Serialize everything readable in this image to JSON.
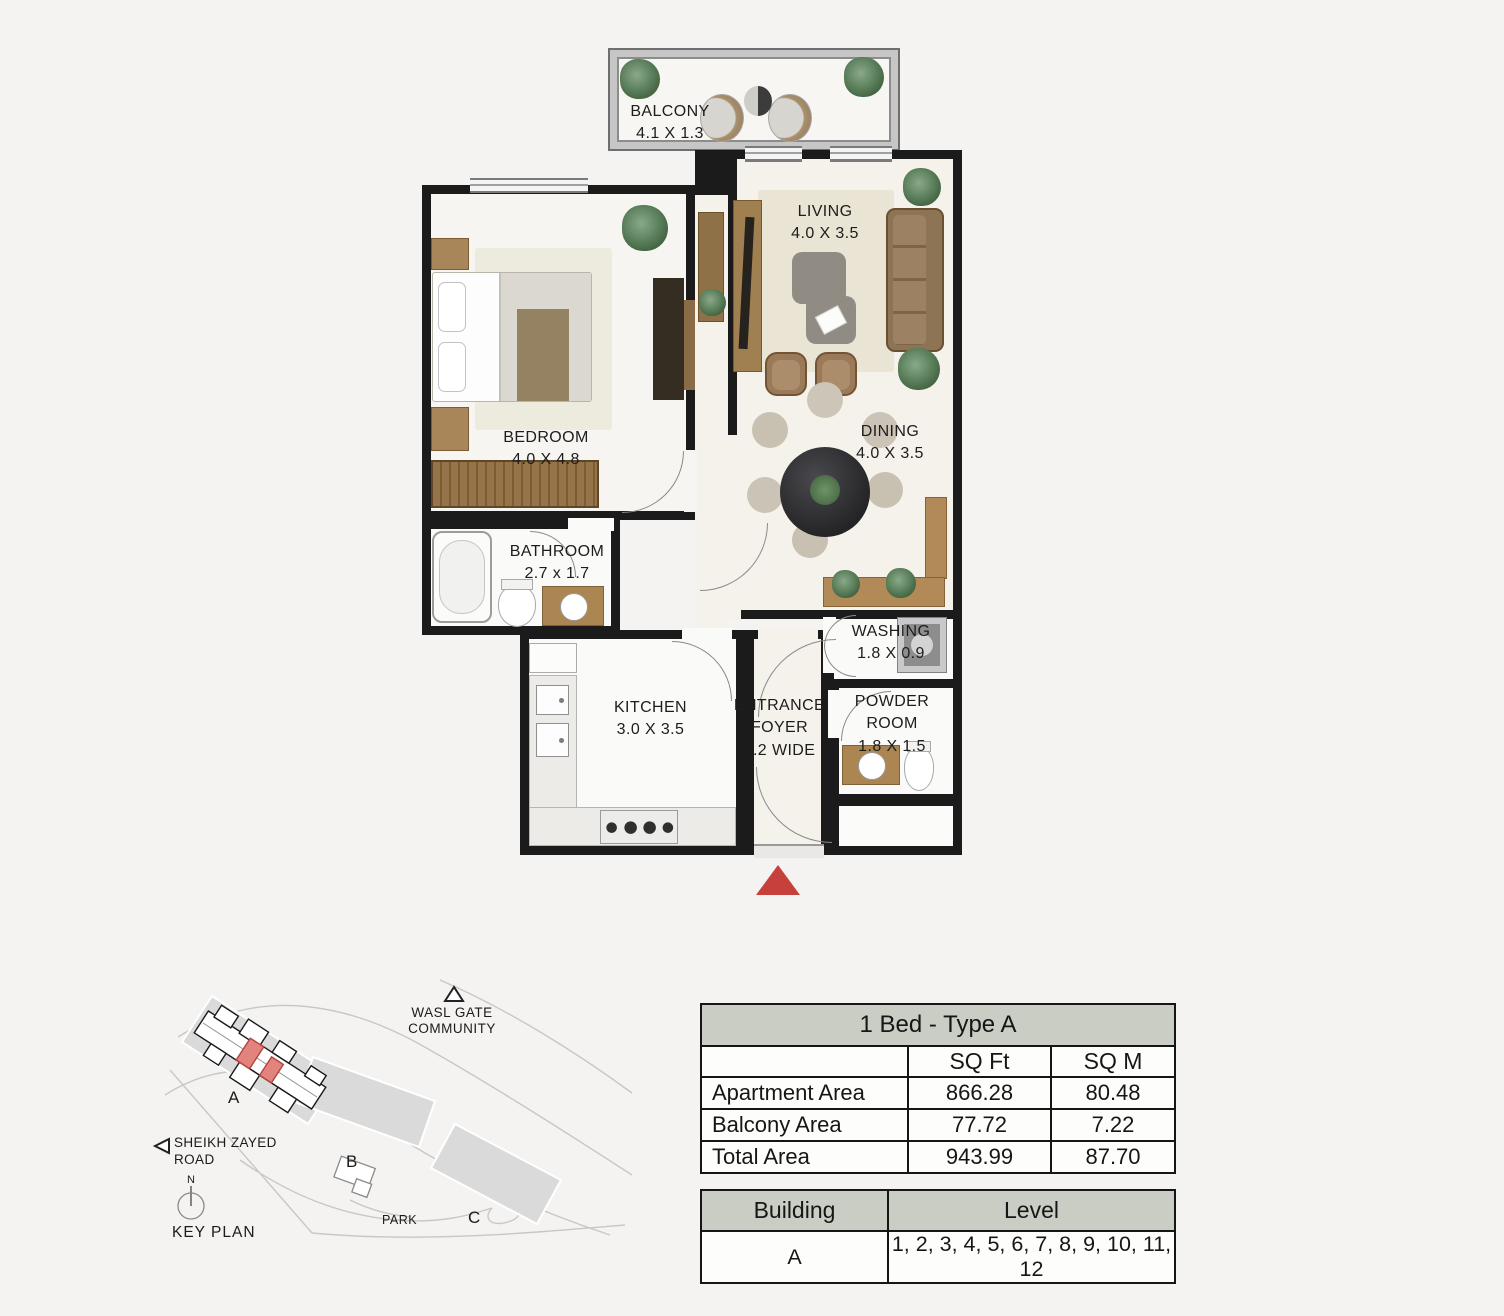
{
  "floor_plan": {
    "rooms": {
      "balcony": {
        "label": "BALCONY",
        "dims": "4.1 X 1.3"
      },
      "living": {
        "label": "LIVING",
        "dims": "4.0 X 3.5"
      },
      "bedroom": {
        "label": "BEDROOM",
        "dims": "4.0 X 4.8"
      },
      "dining": {
        "label": "DINING",
        "dims": "4.0 X 3.5"
      },
      "bathroom": {
        "label": "BATHROOM",
        "dims": "2.7 x 1.7"
      },
      "washing": {
        "label": "WASHING",
        "dims": "1.8 X 0.9"
      },
      "kitchen": {
        "label": "KITCHEN",
        "dims": "3.0 X 3.5"
      },
      "entrance_foyer": {
        "line1": "ENTRANCE",
        "line2": "FOYER",
        "dims": "1.2 WIDE"
      },
      "powder_room": {
        "line1": "POWDER",
        "line2": "ROOM",
        "dims": "1.8 X 1.5"
      }
    }
  },
  "key_plan": {
    "title": "KEY PLAN",
    "community_line1": "WASL GATE",
    "community_line2": "COMMUNITY",
    "road_line1": "SHEIKH ZAYED",
    "road_line2": "ROAD",
    "park_label": "PARK",
    "north_label": "N",
    "building_a": "A",
    "building_b": "B",
    "building_c": "C"
  },
  "area_table": {
    "title": "1 Bed - Type A",
    "unit_headers": [
      "SQ Ft",
      "SQ M"
    ],
    "rows": [
      {
        "label": "Apartment Area",
        "sqft": "866.28",
        "sqm": "80.48"
      },
      {
        "label": "Balcony Area",
        "sqft": "77.72",
        "sqm": "7.22"
      },
      {
        "label": "Total Area",
        "sqft": "943.99",
        "sqm": "87.70"
      }
    ]
  },
  "building_table": {
    "building_header": "Building",
    "level_header": "Level",
    "rows": [
      {
        "building": "A",
        "levels": "1, 2, 3, 4, 5, 6, 7, 8, 9, 10, 11, 12"
      }
    ]
  },
  "colors": {
    "wall": "#1b1b1b",
    "table_header_bg": "#c9cdc3",
    "accent_red": "#c7413c",
    "highlight_unit_red": "#e2837d"
  }
}
